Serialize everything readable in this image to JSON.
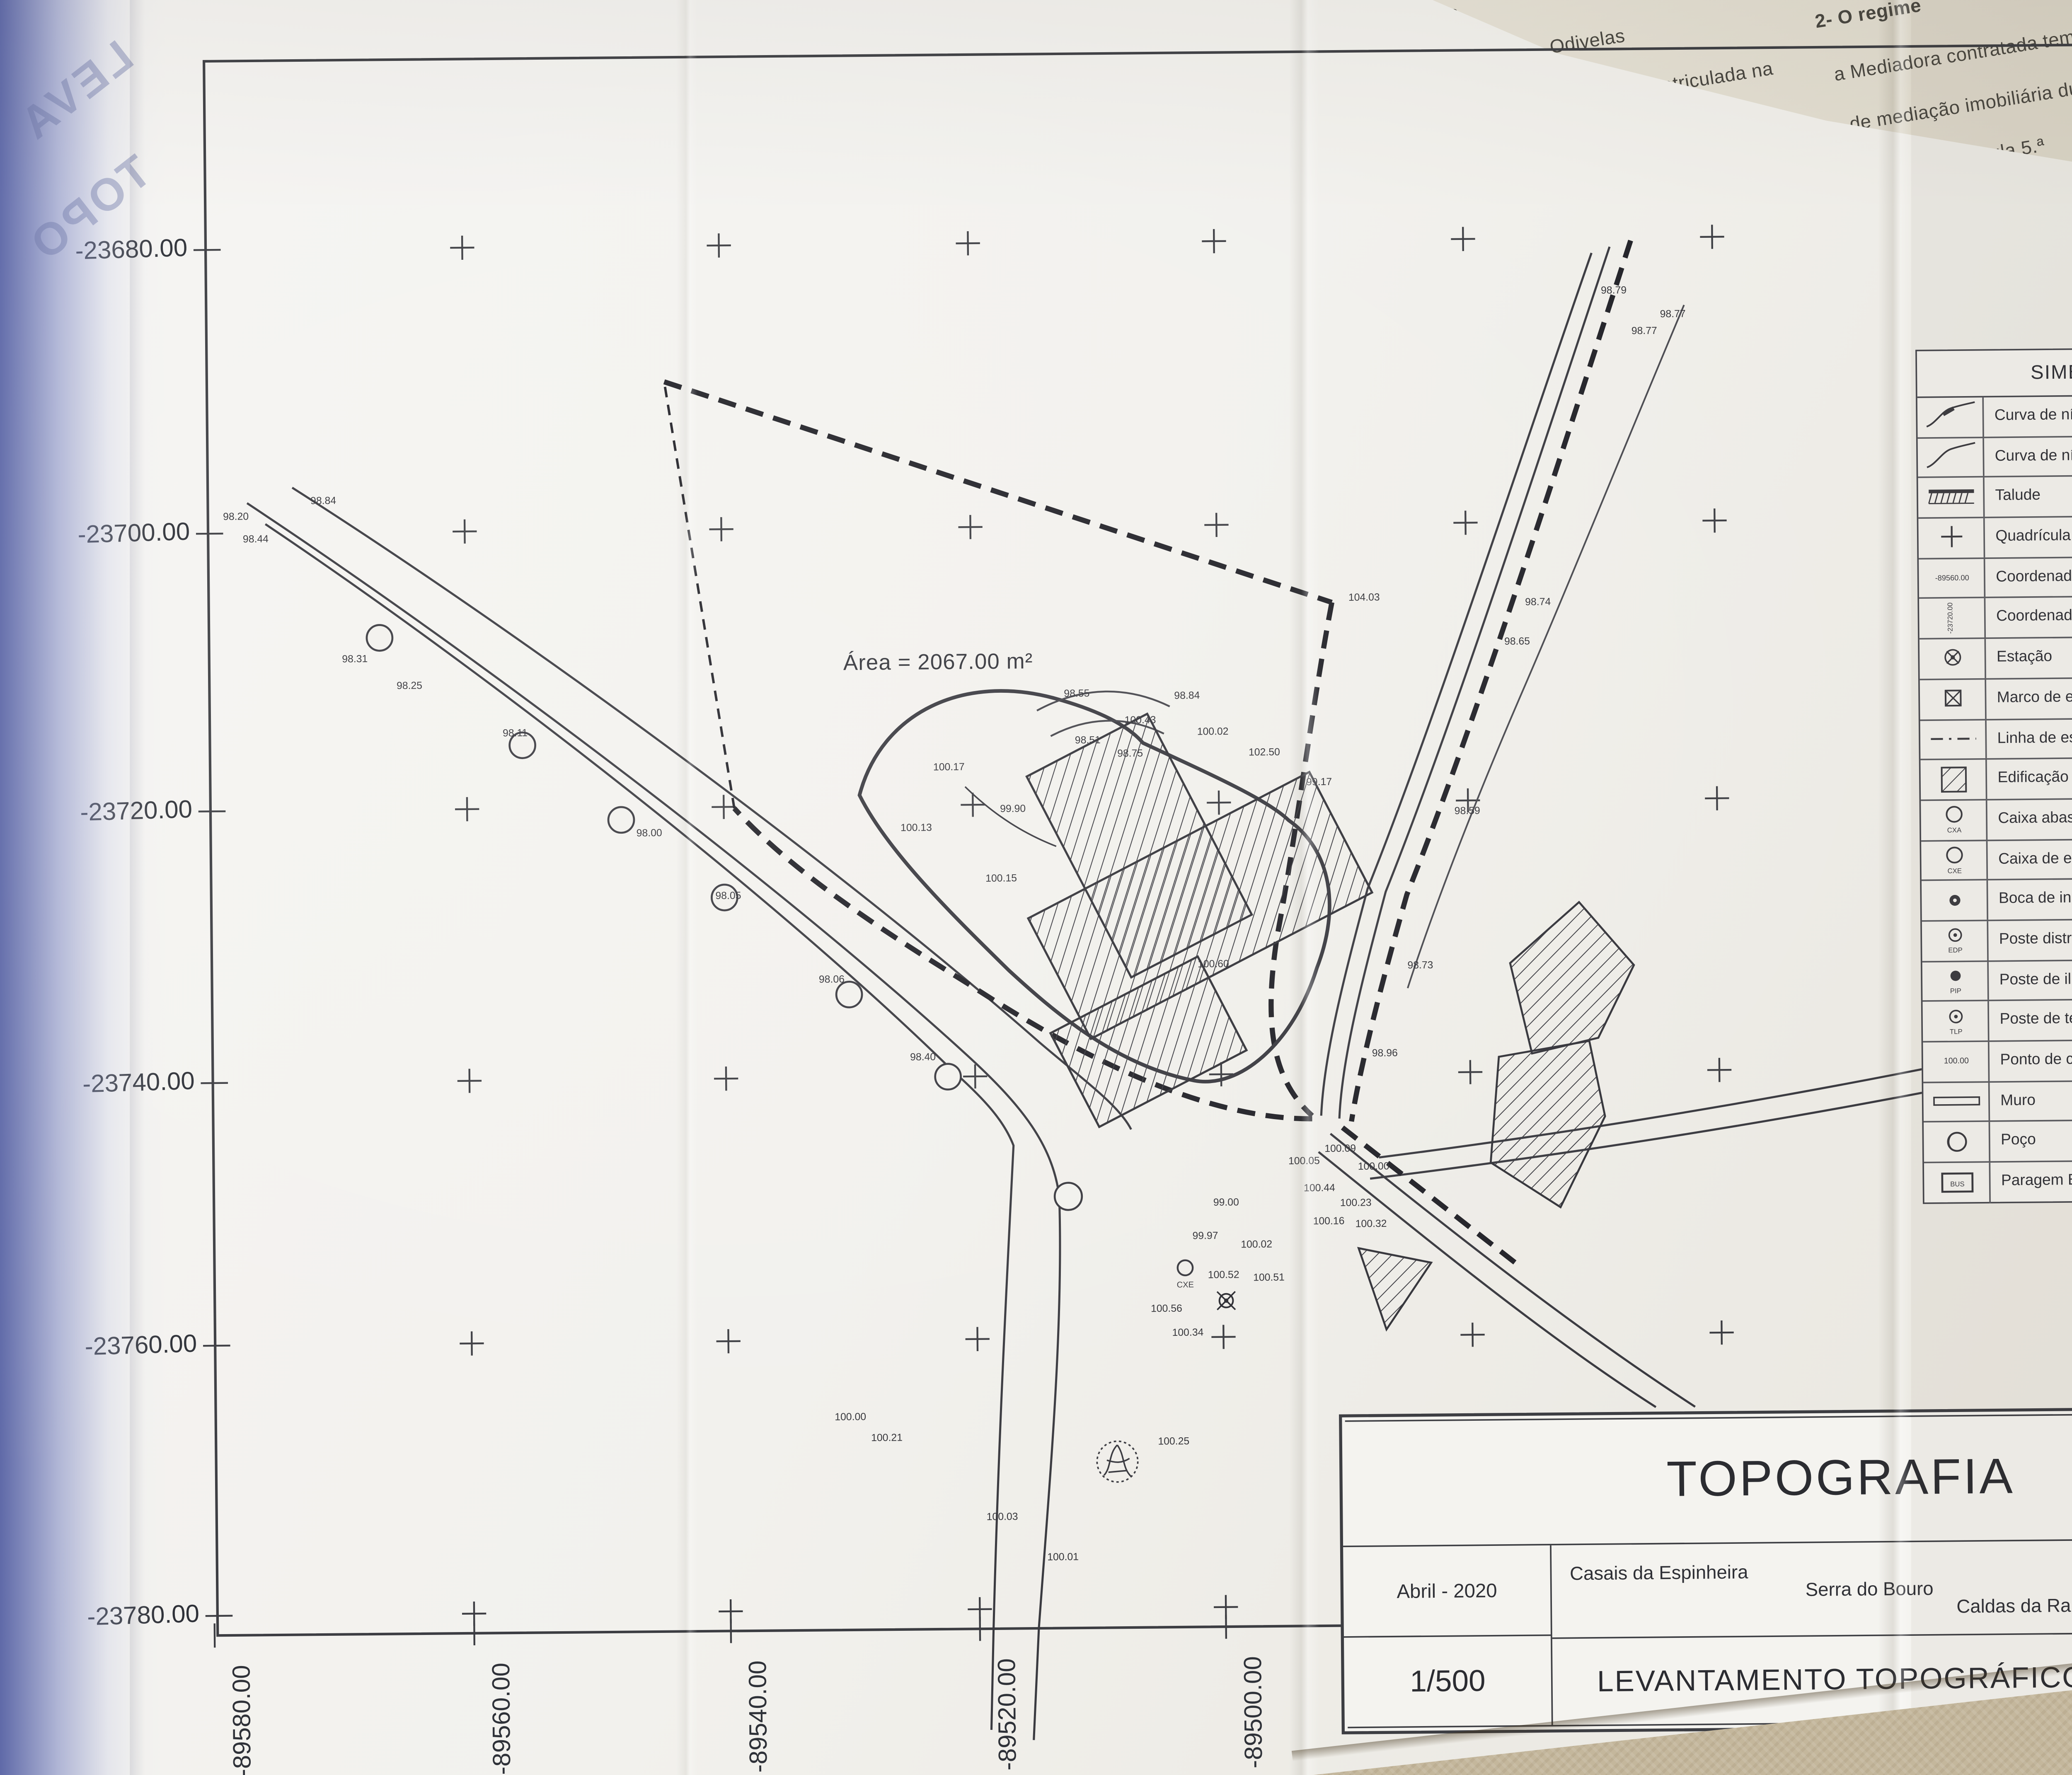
{
  "photo": {
    "background_sheet_fragments": [
      "a social na",
      "Adrião. Odivelas",
      "15362107, matriculada na",
      "detentora da",
      "do",
      "2- O regime",
      "a Mediadora contratada tem",
      "de mediação imobiliária durante o resp",
      "ula 5.ª",
      "ssado que"
    ],
    "spine_showthrough": [
      "LEVA",
      "TOPO"
    ]
  },
  "drawing": {
    "north_label": "NORTE",
    "area_label": "Área = 2067.00 m²",
    "grid": {
      "y_labels": [
        "-23680.00",
        "-23700.00",
        "-23720.00",
        "-23740.00",
        "-23760.00",
        "-23780.00"
      ],
      "x_labels": [
        "-89580.00",
        "-89560.00",
        "-89540.00",
        "-89520.00",
        "-89500.00"
      ]
    },
    "legend": {
      "title": "SIMBOLOGIA",
      "items": [
        {
          "symbol": "contour-major-icon",
          "label": "Curva de nível mestra com cota"
        },
        {
          "symbol": "contour-minor-icon",
          "label": "Curva de nível secundária"
        },
        {
          "symbol": "slope-icon",
          "label": "Talude"
        },
        {
          "symbol": "grid-cross-icon",
          "label": "Quadrícula de coordenação"
        },
        {
          "symbol": "coord-p-icon",
          "label": "Coordenada p",
          "tag": "-89560.00"
        },
        {
          "symbol": "coord-m-icon",
          "label": "Coordenada m",
          "tag": "-23720.00"
        },
        {
          "symbol": "station-icon",
          "label": "Estação"
        },
        {
          "symbol": "boundary-mark-icon",
          "label": "Marco de estrema de propriedade"
        },
        {
          "symbol": "boundary-line-icon",
          "label": "Linha de estrema"
        },
        {
          "symbol": "building-icon",
          "label": "Edificação"
        },
        {
          "symbol": "water-box-icon",
          "label": "Caixa abastecimento de água",
          "tag": "CXA"
        },
        {
          "symbol": "sewer-box-icon",
          "label": "Caixa de esgoto doméstico",
          "tag": "CXE"
        },
        {
          "symbol": "hydrant-icon",
          "label": "Boca de incêndio"
        },
        {
          "symbol": "edp-pole-icon",
          "label": "Poste distribuição EDP",
          "tag": "EDP"
        },
        {
          "symbol": "light-pole-icon",
          "label": "Poste de iluminação",
          "tag": "PIP"
        },
        {
          "symbol": "telecom-pole-icon",
          "label": "Poste de telecomunicações",
          "tag": "TLP"
        },
        {
          "symbol": "spot-elevation-icon",
          "label": "Ponto de cota",
          "tag": "100.00"
        },
        {
          "symbol": "wall-icon",
          "label": "Muro"
        },
        {
          "symbol": "well-icon",
          "label": "Poço"
        },
        {
          "symbol": "bus-stop-icon",
          "label": "Paragem BUS",
          "tag": "BUS"
        }
      ]
    },
    "title_block": {
      "project": "TOPOGRAFIA",
      "date": "Abril - 2020",
      "locality": "Casais da Espinheira",
      "parish": "Serra do Bouro",
      "municipality": "Caldas da Rainha",
      "scale": "1/500",
      "drawing_title": "LEVANTAMENTO TOPOGRÁFICO",
      "sheet_number": "02"
    },
    "spot_elevations": [
      [
        150,
        339,
        "98.20"
      ],
      [
        163,
        354,
        "98.44"
      ],
      [
        208,
        329,
        "98.84"
      ],
      [
        228,
        434,
        "98.31"
      ],
      [
        264,
        452,
        "98.25"
      ],
      [
        334,
        484,
        "98.11"
      ],
      [
        422,
        551,
        "98.00"
      ],
      [
        474,
        593,
        "98.05"
      ],
      [
        542,
        649,
        "98.06"
      ],
      [
        602,
        701,
        "98.40"
      ],
      [
        706,
        461,
        "98.55"
      ],
      [
        779,
        463,
        "98.84"
      ],
      [
        713,
        492,
        "98.51"
      ],
      [
        741,
        501,
        "98.75"
      ],
      [
        619,
        509,
        "100.17"
      ],
      [
        597,
        549,
        "100.13"
      ],
      [
        663,
        537,
        "99.90"
      ],
      [
        653,
        583,
        "100.15"
      ],
      [
        793,
        641,
        "100.60"
      ],
      [
        746,
        479,
        "100.43"
      ],
      [
        794,
        487,
        "100.02"
      ],
      [
        828,
        501,
        "102.50"
      ],
      [
        866,
        521,
        "99.17"
      ],
      [
        895,
        399,
        "104.03"
      ],
      [
        1064,
        197,
        "98.79"
      ],
      [
        1084,
        224,
        "98.77"
      ],
      [
        1103,
        213,
        "98.77"
      ],
      [
        1012,
        403,
        "98.74"
      ],
      [
        998,
        429,
        "98.65"
      ],
      [
        964,
        541,
        "98.59"
      ],
      [
        932,
        643,
        "98.73"
      ],
      [
        908,
        701,
        "98.96"
      ],
      [
        802,
        799,
        "99.00"
      ],
      [
        788,
        821,
        "99.97"
      ],
      [
        820,
        827,
        "100.02"
      ],
      [
        798,
        847,
        "100.52"
      ],
      [
        828,
        849,
        "100.51"
      ],
      [
        760,
        869,
        "100.56"
      ],
      [
        774,
        885,
        "100.34"
      ],
      [
        852,
        772,
        "100.05"
      ],
      [
        876,
        764,
        "100.09"
      ],
      [
        898,
        776,
        "100.00"
      ],
      [
        862,
        790,
        "100.44"
      ],
      [
        886,
        800,
        "100.23"
      ],
      [
        868,
        812,
        "100.16"
      ],
      [
        896,
        814,
        "100.32"
      ],
      [
        550,
        939,
        "100.00"
      ],
      [
        574,
        953,
        "100.21"
      ],
      [
        764,
        957,
        "100.25"
      ],
      [
        650,
        1006,
        "100.03"
      ],
      [
        690,
        1033,
        "100.01"
      ]
    ]
  }
}
